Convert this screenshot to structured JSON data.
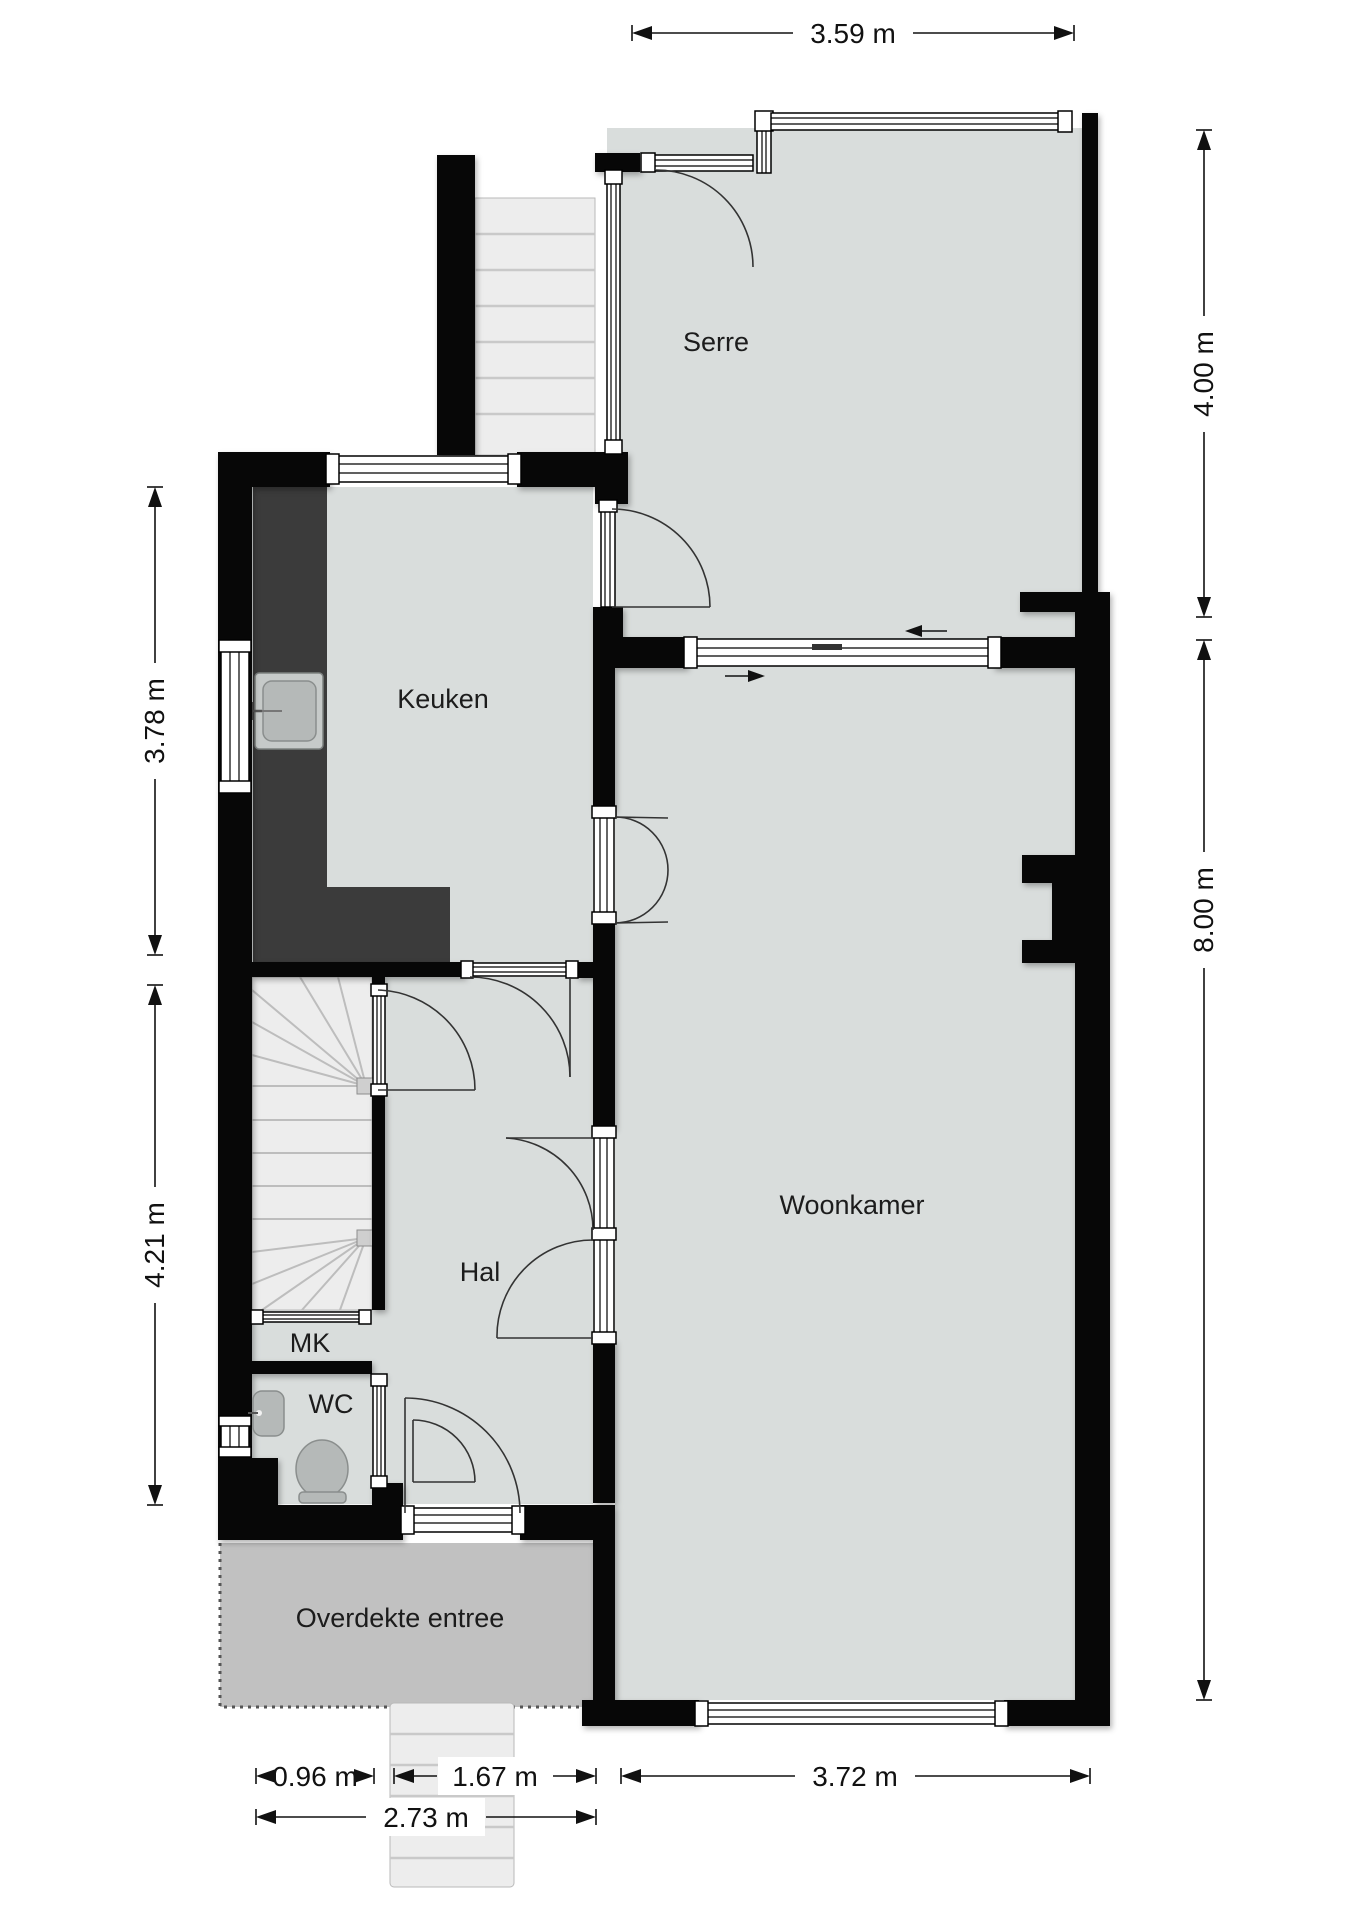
{
  "colors": {
    "floor": "#d9dddc",
    "entree": "#c1c1c1",
    "wall": "#070707",
    "counter": "#3b3b3b",
    "stairs": "#ededed",
    "fixture": "#b5b9b8",
    "line": "#333333",
    "dim": "#111111"
  },
  "rooms": {
    "serre": {
      "label": "Serre"
    },
    "keuken": {
      "label": "Keuken"
    },
    "woonkamer": {
      "label": "Woonkamer"
    },
    "hal": {
      "label": "Hal"
    },
    "mk": {
      "label": "MK"
    },
    "wc": {
      "label": "WC"
    },
    "entree": {
      "label": "Overdekte entree"
    }
  },
  "dimensions": {
    "top": "3.59 m",
    "right_upper": "4.00 m",
    "right_lower": "8.00 m",
    "left_upper": "3.78 m",
    "left_lower": "4.21 m",
    "bottom_left": "0.96 m",
    "bottom_mid": "1.67 m",
    "bottom_right": "3.72 m",
    "bottom_total": "2.73 m"
  }
}
